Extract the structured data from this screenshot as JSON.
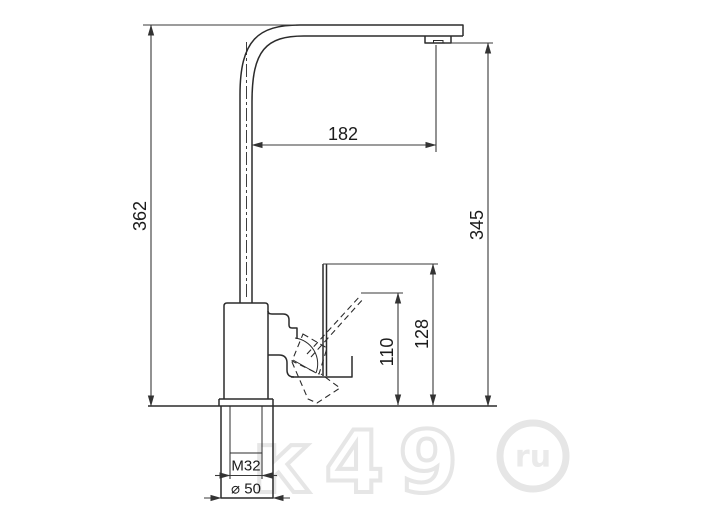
{
  "drawing": {
    "title": "kitchen-faucet-dimension-drawing",
    "dims": {
      "total_height": "362",
      "spout_reach": "182",
      "spout_height": "345",
      "lever_height": "110",
      "cartridge_height": "128",
      "thread_size": "M32",
      "base_diameter": "⌀ 50"
    },
    "watermark": {
      "text": "к49",
      "badge": "ru"
    },
    "colors": {
      "outline": "#2b2b2b",
      "dimension": "#3a3a3a",
      "text": "#1b1b1b",
      "watermark": "#e6e6e6",
      "background": "#ffffff"
    }
  }
}
